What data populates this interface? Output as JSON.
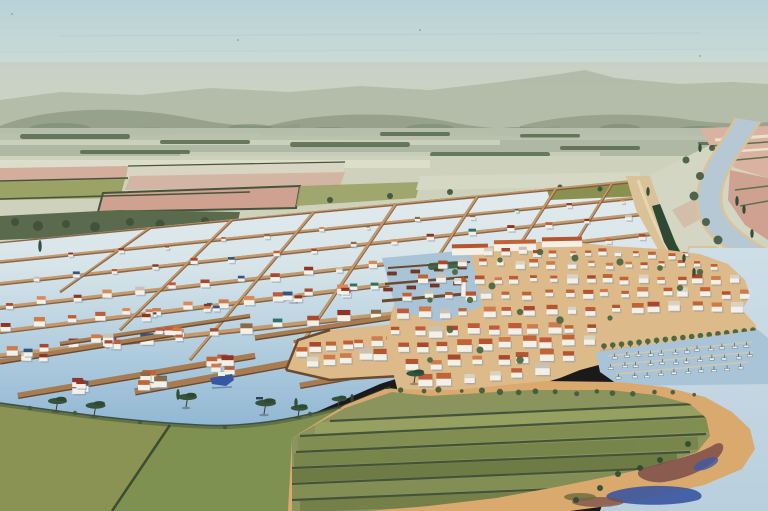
{
  "meta": {
    "kind": "watercolor-illustration",
    "subject": "aerial bird's-eye watercolor view of a lagoon town: flooded parcel grid with dike roads and stilt houses, winding river, terracotta-roofed coastal town with harbor and marina, green farm fields and sandy peninsula in foreground"
  },
  "palette": {
    "sky_top": "#b7d2d9",
    "sky_mid": "#cfdcd4",
    "sky_horizon": "#e4e4d3",
    "haze": "#c3c8b6",
    "hills_far": "#aeb6a4",
    "hills_mid": "#8d9a83",
    "hills_deep": "#798a72",
    "midband": "#b7c0ad",
    "mid_streak": "#d6dac6",
    "clump_dark": "#55684e",
    "plain": "#ced2bc",
    "strip_pale": "#dcdecb",
    "strip_pink": "#d3ae9c",
    "strip_pink2": "#cfa191",
    "strip_olive": "#9aa266",
    "band_dark": "#5a6a4c",
    "hedge_dark": "#46543c",
    "pinkfield": "#d9b2a2",
    "pinkfield2": "#cfa191",
    "hedge_green": "#5e7050",
    "river": "#b6c8d4",
    "sand": "#ddc296",
    "levee": "#d9c298",
    "levee_road": "#e7d6b2",
    "water_top": "#e4ecee",
    "water_mid": "#d6e4e9",
    "water_low": "#aecbdd",
    "water_deep": "#8fb6d3",
    "sea_top": "#cedee7",
    "sea_low": "#b9cfdd",
    "parcel_olive": "#8a9150",
    "dike_tan": "#c49a6c",
    "dike_brown": "#7e583a",
    "jetty_dark": "#5f3f26",
    "jetty_top": "#a87c50",
    "building_white": "#f3f0e7",
    "boat_blue": "#3558a0",
    "town_sand": "#dcba8a",
    "quay_sand": "#d2a878",
    "marina_water": "#a9c4d6",
    "boat_red": "#7e3526",
    "tree_green": "#4d6843",
    "pine_dark": "#35523a",
    "cypress": "#2e4833",
    "trunk": "#4a3828",
    "field_base": "#7f9150",
    "field_left": "#8a9254",
    "striped_base": "#8a945c",
    "hedge_field": "#36462f",
    "shore_sand": "#d9a96e",
    "pond_blue": "#3a55a0",
    "marsh_purple": "#7b4e49",
    "shadow_blue": "#7d95ab"
  },
  "scene": {
    "roofs": [
      "#bf5b38",
      "#cd7a4d",
      "#a8482e",
      "#8f3526",
      "#c06436",
      "#d98a58"
    ],
    "accents": [
      "#34557e",
      "#317066",
      "#8a6a4a",
      "#c9c2b4",
      "#8f3526"
    ],
    "town_roof_mix": [
      "#bf5b38",
      "#cd7a4d",
      "#a8482e",
      "#c06436",
      "#b5552f",
      "#c06436",
      "#cd7a4d",
      "#bf5b38",
      "#c9c2b4",
      "#d8d2c2"
    ],
    "band_colors": [
      "#97a161",
      "#828d52",
      "#78854a",
      "#6d7a44",
      "#838e55",
      "#747f47"
    ],
    "dikes": [
      [
        0,
        242,
        632,
        182,
        1.6
      ],
      [
        0,
        262,
        638,
        198,
        2
      ],
      [
        0,
        284,
        646,
        214,
        2.4
      ],
      [
        0,
        308,
        652,
        234,
        2.8
      ],
      [
        0,
        332,
        658,
        252,
        3.2
      ],
      [
        0,
        356,
        600,
        292,
        3.6
      ]
    ],
    "cross_dikes": [
      [
        150,
        228,
        60,
        292,
        1.5
      ],
      [
        232,
        220,
        120,
        330,
        1.8
      ],
      [
        314,
        212,
        190,
        360,
        2
      ],
      [
        396,
        204,
        285,
        368,
        2.2
      ],
      [
        478,
        196,
        380,
        345,
        2
      ],
      [
        556,
        189,
        470,
        322,
        2
      ],
      [
        612,
        184,
        540,
        300,
        1.8
      ]
    ],
    "grid_rows": [
      [
        70,
        256,
        620,
        202,
        12,
        3
      ],
      [
        36,
        280,
        630,
        218,
        16,
        4
      ],
      [
        8,
        305,
        640,
        238,
        20,
        5
      ],
      [
        8,
        328,
        645,
        256,
        22,
        6
      ],
      [
        10,
        352,
        580,
        296,
        18,
        7
      ],
      [
        420,
        330,
        600,
        300,
        6,
        6
      ]
    ],
    "town_rows": [
      [
        486,
        252,
        688,
        256,
        13,
        4.5
      ],
      [
        446,
        264,
        716,
        266,
        16,
        5
      ],
      [
        424,
        280,
        736,
        280,
        18,
        5.5
      ],
      [
        410,
        296,
        744,
        294,
        18,
        6
      ],
      [
        402,
        314,
        740,
        308,
        17,
        6.5
      ],
      [
        398,
        332,
        590,
        330,
        11,
        7
      ],
      [
        404,
        348,
        590,
        342,
        10,
        7.5
      ],
      [
        412,
        366,
        570,
        356,
        8,
        8
      ],
      [
        424,
        382,
        540,
        372,
        6,
        8
      ]
    ],
    "platform_rows": [
      [
        302,
        352,
        392,
        341,
        7,
        6.5
      ],
      [
        312,
        364,
        398,
        353,
        6,
        7
      ]
    ],
    "jetties": [
      [
        0,
        362,
        175,
        334,
        4
      ],
      [
        18,
        396,
        255,
        356,
        5
      ],
      [
        135,
        392,
        430,
        338,
        6
      ],
      [
        60,
        344,
        250,
        316,
        3
      ],
      [
        255,
        338,
        470,
        306,
        4
      ],
      [
        300,
        386,
        470,
        356,
        5
      ]
    ],
    "stilt_clusters": [
      [
        35,
        354,
        4,
        7
      ],
      [
        105,
        344,
        5,
        7
      ],
      [
        168,
        336,
        4,
        7
      ],
      [
        70,
        388,
        5,
        8
      ],
      [
        150,
        382,
        6,
        8
      ],
      [
        225,
        366,
        5,
        8
      ],
      [
        310,
        350,
        5,
        8
      ],
      [
        380,
        340,
        4,
        8
      ],
      [
        150,
        316,
        3,
        5
      ],
      [
        215,
        308,
        4,
        5
      ],
      [
        295,
        300,
        4,
        6
      ],
      [
        350,
        292,
        3,
        6
      ],
      [
        420,
        330,
        5,
        7
      ],
      [
        455,
        316,
        4,
        6
      ],
      [
        330,
        374,
        4,
        8
      ],
      [
        390,
        362,
        4,
        8
      ]
    ],
    "marina_rows": [
      [
        614,
        358,
        746,
        346,
        12
      ],
      [
        612,
        368,
        750,
        356,
        12
      ],
      [
        620,
        378,
        742,
        368,
        10
      ]
    ],
    "harbor_boat_rows": [
      [
        392,
        272,
        462,
        266,
        4
      ],
      [
        388,
        288,
        458,
        282,
        4
      ]
    ],
    "promenade": [
      604,
      347,
      753,
      331,
      18
    ],
    "town_trees": [
      [
        430,
        300
      ],
      [
        455,
        272
      ],
      [
        500,
        260
      ],
      [
        540,
        252
      ],
      [
        575,
        258
      ],
      [
        620,
        262
      ],
      [
        660,
        268
      ],
      [
        700,
        272
      ],
      [
        470,
        300
      ],
      [
        520,
        312
      ],
      [
        560,
        320
      ],
      [
        610,
        318
      ],
      [
        450,
        330
      ],
      [
        480,
        350
      ],
      [
        520,
        360
      ],
      [
        430,
        360
      ],
      [
        492,
        286
      ],
      [
        680,
        288
      ]
    ],
    "pines": [
      [
        56,
        411,
        1
      ],
      [
        94,
        416,
        1.05
      ],
      [
        186,
        407,
        1
      ],
      [
        264,
        414,
        1.1
      ],
      [
        298,
        417,
        0.9
      ],
      [
        414,
        383,
        0.95
      ],
      [
        338,
        407,
        0.8
      ]
    ],
    "cypresses": [
      [
        178,
        400,
        11
      ],
      [
        296,
        408,
        10
      ],
      [
        352,
        402,
        8
      ],
      [
        737,
        206,
        10
      ],
      [
        744,
        214,
        9
      ],
      [
        752,
        238,
        9
      ],
      [
        700,
        152,
        8
      ],
      [
        648,
        196,
        9
      ],
      [
        684,
        262,
        8
      ],
      [
        694,
        276,
        8
      ],
      [
        40,
        252,
        12
      ]
    ],
    "bank_trees": [
      [
        700,
        176,
        4
      ],
      [
        694,
        196,
        4.5
      ],
      [
        706,
        222,
        4
      ],
      [
        718,
        240,
        4.5
      ],
      [
        733,
        252,
        4
      ],
      [
        686,
        160,
        3.5
      ],
      [
        712,
        148,
        3
      ]
    ],
    "mid_clumps": [
      [
        20,
        134,
        110,
        5
      ],
      [
        160,
        140,
        90,
        4
      ],
      [
        290,
        142,
        120,
        5
      ],
      [
        80,
        150,
        110,
        4
      ],
      [
        430,
        152,
        120,
        5
      ],
      [
        10,
        158,
        80,
        4
      ],
      [
        240,
        160,
        90,
        4
      ],
      [
        560,
        146,
        80,
        4
      ],
      [
        640,
        156,
        60,
        3
      ],
      [
        380,
        132,
        70,
        4
      ],
      [
        520,
        134,
        60,
        3.5
      ],
      [
        698,
        142,
        50,
        3
      ]
    ],
    "hill_clumps": [
      [
        60,
        128,
        30,
        5
      ],
      [
        150,
        132,
        26,
        4.5
      ],
      [
        250,
        128,
        22,
        4
      ],
      [
        330,
        132,
        28,
        5
      ],
      [
        430,
        128,
        24,
        4
      ],
      [
        520,
        132,
        30,
        5
      ],
      [
        620,
        128,
        20,
        4
      ],
      [
        700,
        130,
        24,
        4
      ]
    ],
    "field_clumps": [
      [
        15,
        222,
        4
      ],
      [
        38,
        226,
        5
      ],
      [
        66,
        224,
        4
      ],
      [
        95,
        227,
        5
      ],
      [
        130,
        222,
        4
      ],
      [
        160,
        224,
        4.5
      ],
      [
        205,
        221,
        4
      ],
      [
        230,
        226,
        4.5
      ],
      [
        330,
        200,
        3
      ],
      [
        390,
        196,
        3
      ],
      [
        450,
        192,
        3
      ],
      [
        560,
        187,
        2.5
      ]
    ],
    "strip_hedges": [
      [
        330,
        421,
        716,
        403
      ],
      [
        300,
        436,
        712,
        416
      ],
      [
        296,
        452,
        706,
        434
      ],
      [
        292,
        468,
        690,
        452
      ],
      [
        290,
        484,
        664,
        468
      ],
      [
        292,
        500,
        630,
        486
      ]
    ],
    "strip_bands": [
      [
        315,
        429,
        714,
        409,
        13,
        0
      ],
      [
        298,
        444,
        709,
        425,
        13,
        1
      ],
      [
        294,
        460,
        698,
        443,
        13,
        2
      ],
      [
        291,
        476,
        677,
        460,
        13,
        3
      ],
      [
        291,
        492,
        647,
        477,
        13,
        4
      ],
      [
        300,
        506,
        632,
        494,
        12,
        5
      ]
    ],
    "bush_row_top": [
      402,
      390,
      692,
      394,
      16
    ],
    "shore_bushes": [
      [
        30,
        408
      ],
      [
        75,
        413
      ],
      [
        140,
        422
      ],
      [
        225,
        427
      ],
      [
        310,
        414
      ]
    ],
    "marsh_bushes": [
      [
        618,
        474
      ],
      [
        640,
        468
      ],
      [
        600,
        488
      ],
      [
        660,
        460
      ],
      [
        688,
        444
      ],
      [
        576,
        500
      ]
    ],
    "sky_specks": [
      [
        12,
        14
      ],
      [
        238,
        40
      ],
      [
        580,
        96
      ],
      [
        700,
        56
      ],
      [
        420,
        30
      ]
    ]
  }
}
